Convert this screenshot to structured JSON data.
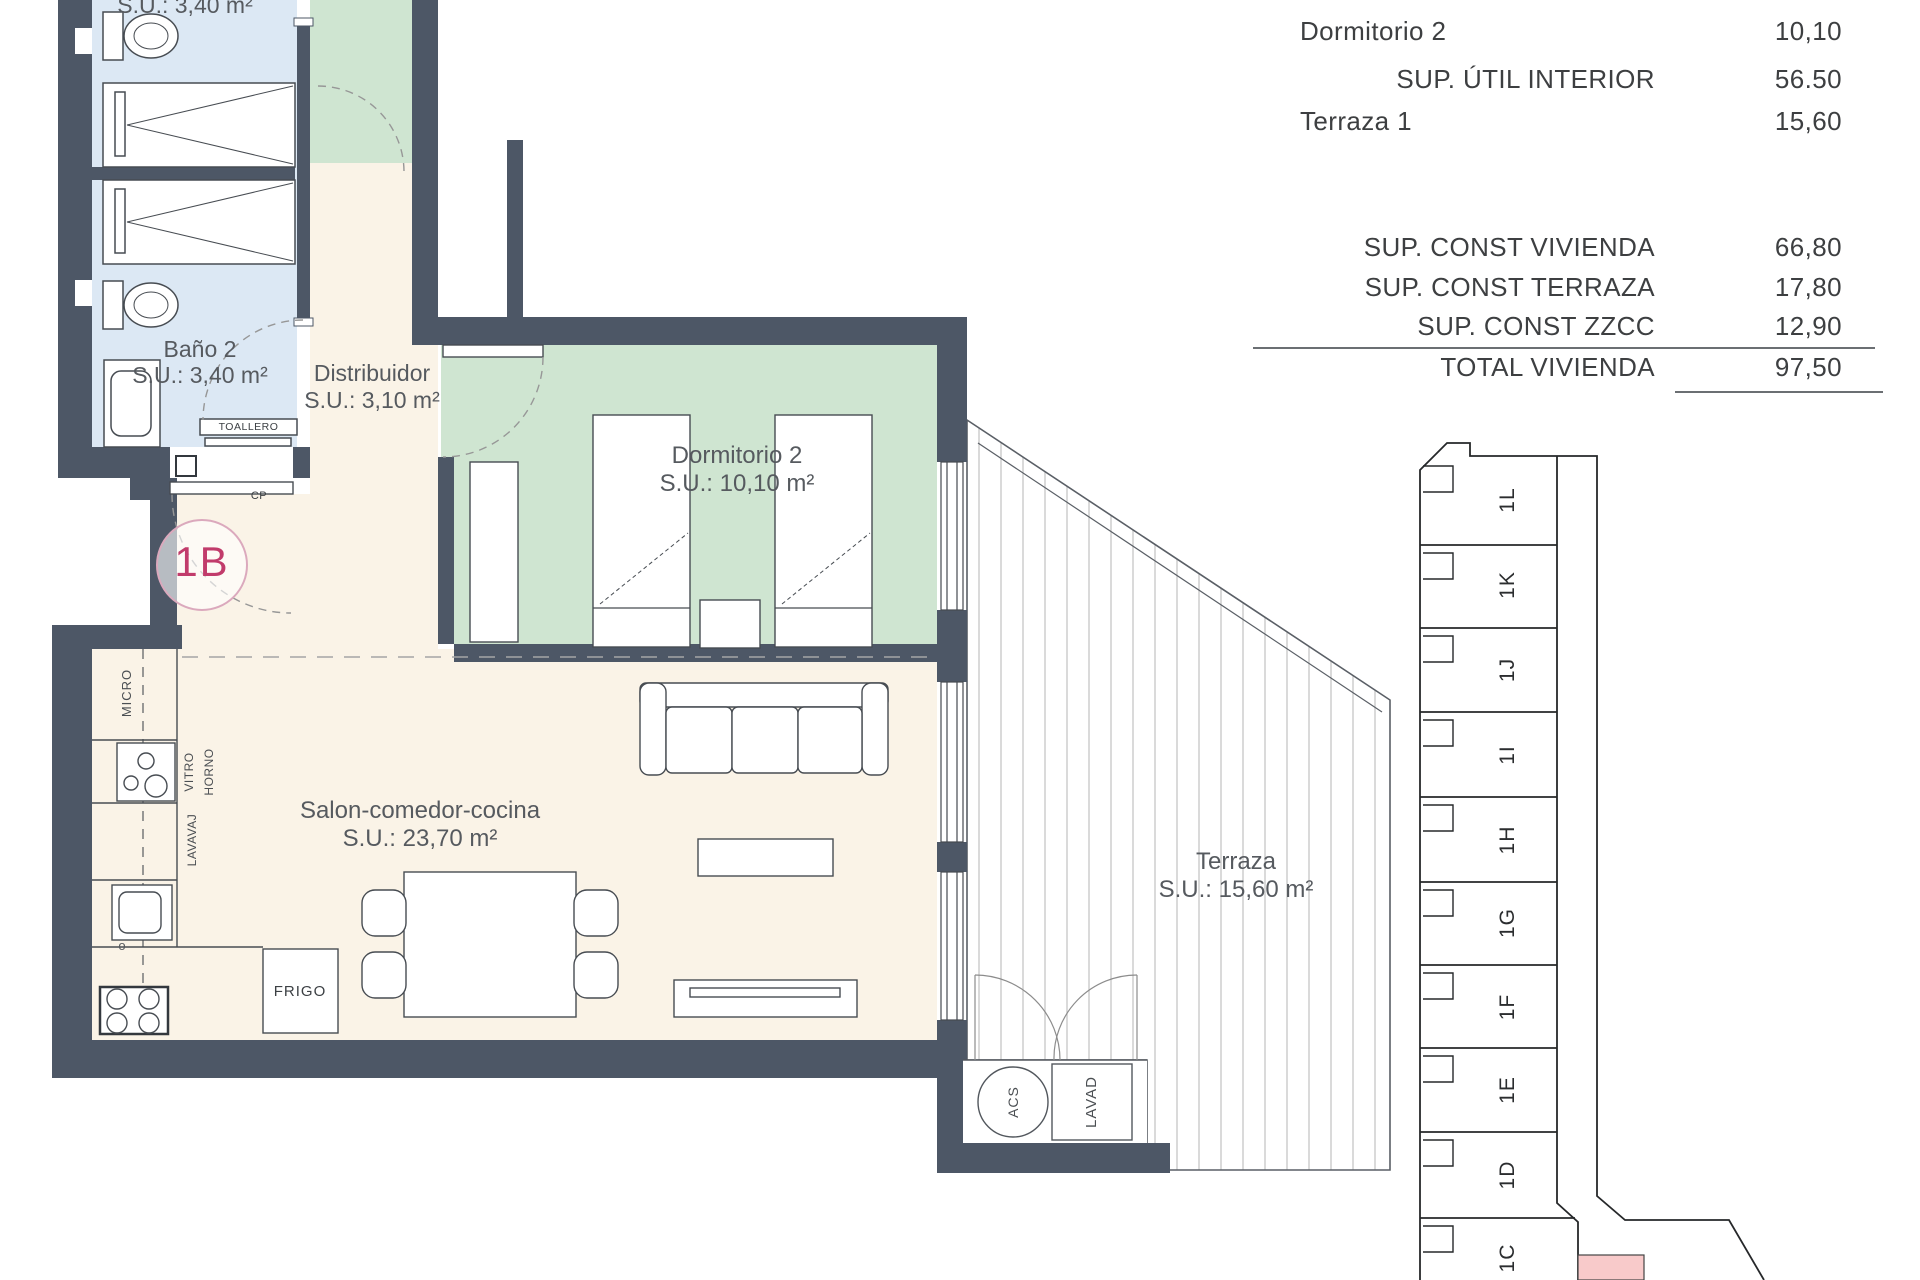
{
  "plan": {
    "unit_badge": "1B",
    "rooms": {
      "bath1_su": "S.U.: 3,40 m²",
      "bath2_name": "Baño 2",
      "bath2_su": "S.U.: 3,40 m²",
      "distribuidor_name": "Distribuidor",
      "distribuidor_su": "S.U.: 3,10 m²",
      "dorm2_name": "Dormitorio 2",
      "dorm2_su": "S.U.: 10,10 m²",
      "salon_name": "Salon-comedor-cocina",
      "salon_su": "S.U.: 23,70 m²",
      "terraza_name": "Terraza",
      "terraza_su": "S.U.: 15,60 m²"
    },
    "fixtures": {
      "toallero": "TOALLERO",
      "micro": "MICRO",
      "vitro": "VITRO",
      "horno": "HORNO",
      "lavavaj": "LAVAVAJ",
      "frigo": "FRIGO",
      "acs": "ACS",
      "lavad": "LAVAD",
      "cp": "CP",
      "o": "o"
    },
    "colors": {
      "wall": "#4d5766",
      "bath_floor": "#dce8f4",
      "room_floor": "#faf3e7",
      "bedroom_floor": "#cfe5d1",
      "accent_pink": "#c13b6b",
      "badge_ring": "#dba9bd",
      "keyplan_highlight": "#f8caca"
    }
  },
  "table": {
    "row_dorm2": {
      "label": "Dormitorio 2",
      "value": "10,10"
    },
    "row_util": {
      "label": "SUP. ÚTIL INTERIOR",
      "value": "56.50"
    },
    "row_terraza1": {
      "label": "Terraza 1",
      "value": "15,60"
    },
    "row_const_viv": {
      "label": "SUP. CONST VIVIENDA",
      "value": "66,80"
    },
    "row_const_ter": {
      "label": "SUP. CONST TERRAZA",
      "value": "17,80"
    },
    "row_const_zzcc": {
      "label": "SUP. CONST ZZCC",
      "value": "12,90"
    },
    "row_total": {
      "label": "TOTAL VIVIENDA",
      "value": "97,50"
    }
  },
  "keyplan": {
    "units": [
      "1L",
      "1K",
      "1J",
      "1I",
      "1H",
      "1G",
      "1F",
      "1E",
      "1D",
      "1C"
    ]
  }
}
